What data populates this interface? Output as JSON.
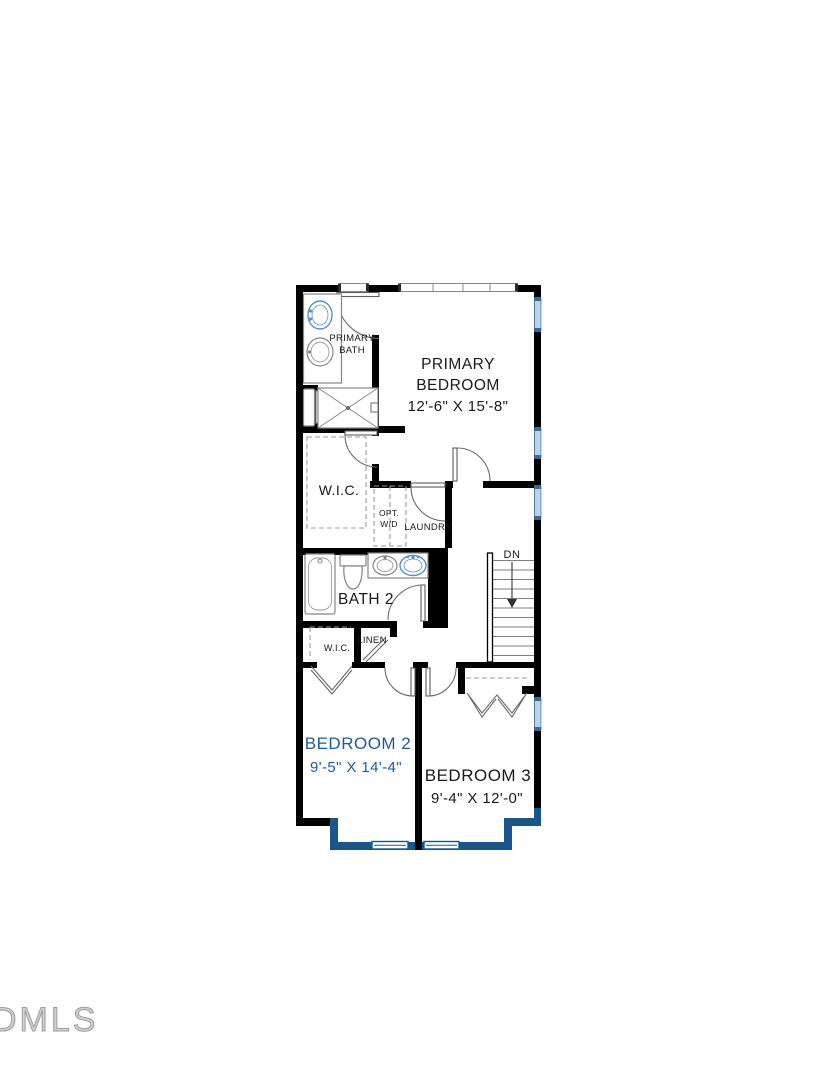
{
  "plan": {
    "watermark": "DMLS",
    "labels": {
      "primary_bath": {
        "line1": "PRIMARY",
        "line2": "BATH"
      },
      "primary_bedroom": {
        "line1": "PRIMARY",
        "line2": "BEDROOM",
        "dims": "12'-6\" X 15'-8\""
      },
      "primary_wic": "W.I.C.",
      "opt_wd": {
        "line1": "OPT.",
        "line2": "W/D"
      },
      "laundry": "LAUNDRY",
      "stairs": {
        "direction": "DN"
      },
      "bath2": "BATH 2",
      "bedroom2_wic": "W.I.C.",
      "linen": "LINEN",
      "bedroom2": {
        "name": "BEDROOM 2",
        "dims": "9'-5\" X 14'-4\""
      },
      "bedroom3": {
        "name": "BEDROOM 3",
        "dims": "9'-4\" X 12'-0\""
      }
    },
    "colors": {
      "wall_black": "#000000",
      "wall_accent_blue": "#17578c",
      "window_light_blue": "#b9d4e6",
      "bedroom2_text_blue": "#1d5c99",
      "fixture_gray": "#868686",
      "watermark_gray": "#9e9e9e"
    }
  }
}
